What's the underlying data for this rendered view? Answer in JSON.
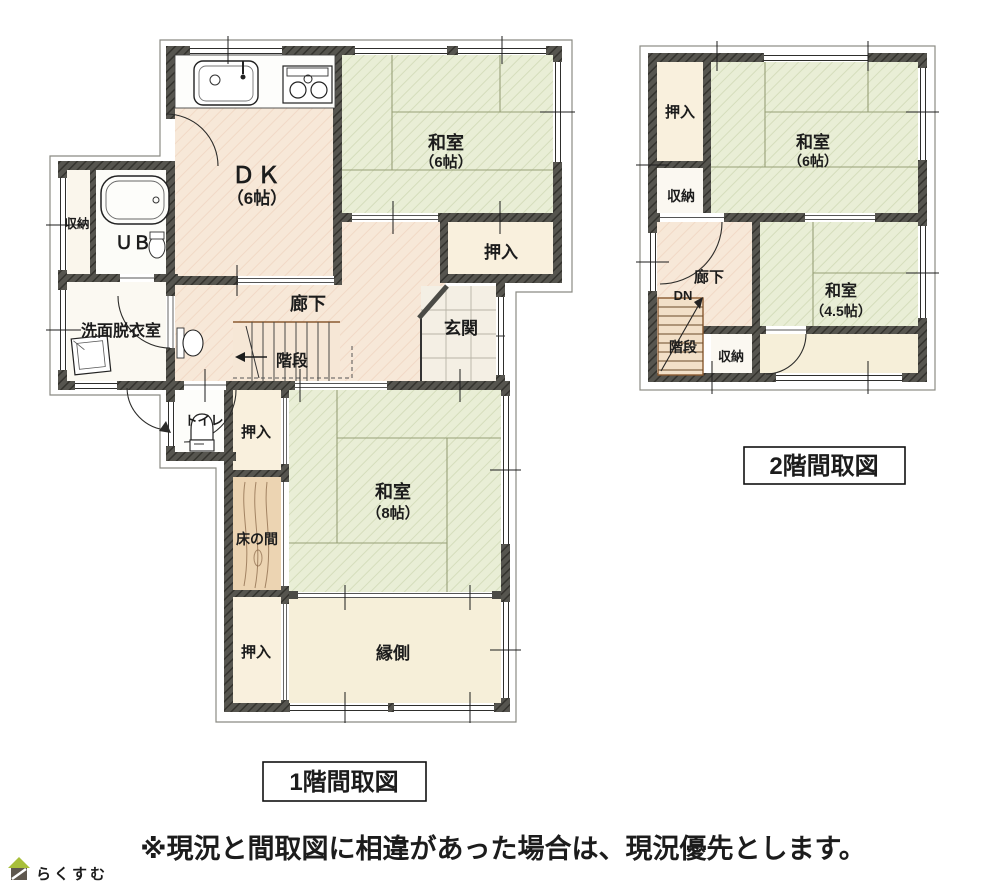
{
  "f1": {
    "caption": "1階間取図",
    "dk1": "ＤＫ",
    "dk2": "（6帖）",
    "washitsu6a": "和室",
    "washitsu6b": "（6帖）",
    "oshiire_e": "押入",
    "rouka": "廊下",
    "kaidan": "階段",
    "genkan": "玄関",
    "ub": "ＵＢ",
    "shunou": "収納",
    "senmen": "洗面脱衣室",
    "toilet": "トイレ",
    "oshiire_n": "押入",
    "tokonoma": "床の間",
    "washitsu8a": "和室",
    "washitsu8b": "（8帖）",
    "oshiire_s": "押入",
    "engawa": "縁側"
  },
  "f2": {
    "caption": "2階間取図",
    "oshiire": "押入",
    "washitsu6a": "和室",
    "washitsu6b": "（6帖）",
    "shunou_n": "収納",
    "rouka": "廊下",
    "dn": "DN",
    "kaidan": "階段",
    "shunou_s": "収納",
    "washitsu45a": "和室",
    "washitsu45b": "（4.5帖）"
  },
  "note": "※現況と間取図に相違があった場合は、現況優先とします。",
  "logo": {
    "text": "らくすむ"
  },
  "colors": {
    "wall": "#4b4b46",
    "tatami": "#e9eed6",
    "wood_floor": "#f7e8d8",
    "closet": "#f9f0dd",
    "veranda": "#f6efd9",
    "tokonoma_wood": "#ecd4b2",
    "logo_roof_green": "#a8bf3a",
    "logo_body_brown": "#5f584e",
    "logo_text": "#9a8d79"
  }
}
